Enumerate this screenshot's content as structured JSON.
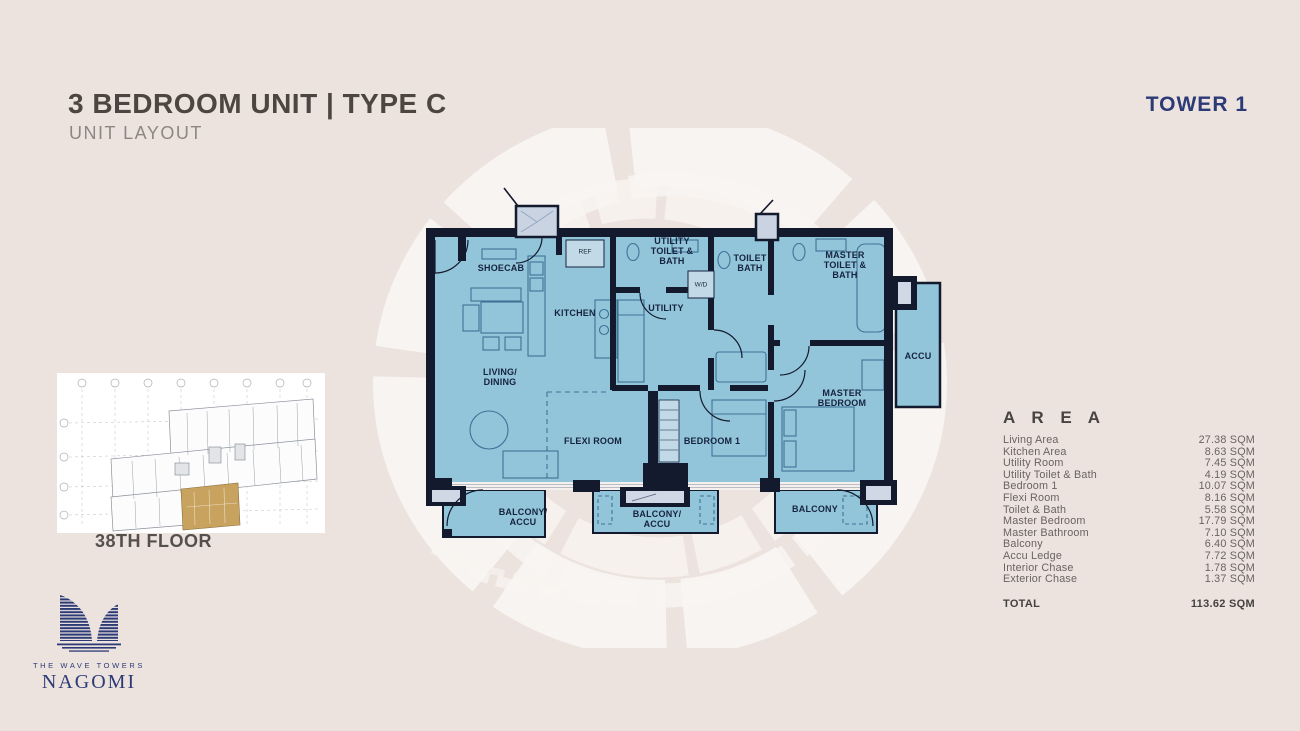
{
  "header": {
    "title": "3 BEDROOM UNIT | TYPE C",
    "subtitle": "UNIT LAYOUT",
    "tower": "TOWER 1"
  },
  "key_plan": {
    "floor_label": "38TH FLOOR"
  },
  "logo": {
    "tagline": "THE WAVE TOWERS",
    "brand": "NAGOMI"
  },
  "floor_plan": {
    "labels": {
      "shoecab": "SHOECAB",
      "ref": "REF",
      "kitchen": "KITCHEN",
      "utility_toilet_bath": "UTILITY\nTOILET &\nBATH",
      "wd": "W/D",
      "utility": "UTILITY",
      "toilet_bath": "TOILET\nBATH",
      "master_toilet_bath": "MASTER\nTOILET &\nBATH",
      "accu": "ACCU",
      "living_dining": "LIVING/\nDINING",
      "flexi_room": "FLEXI ROOM",
      "bedroom_1": "BEDROOM 1",
      "master_bedroom": "MASTER\nBEDROOM",
      "balcony_accu_left": "BALCONY/\nACCU",
      "balcony_accu_mid": "BALCONY/\nACCU",
      "balcony": "BALCONY"
    }
  },
  "area_table": {
    "header": "A R E A",
    "rows": [
      {
        "label": "Living Area",
        "value": "27.38 SQM"
      },
      {
        "label": "Kitchen Area",
        "value": "8.63 SQM"
      },
      {
        "label": "Utility Room",
        "value": "7.45 SQM"
      },
      {
        "label": "Utility Toilet & Bath",
        "value": "4.19 SQM"
      },
      {
        "label": "Bedroom 1",
        "value": "10.07 SQM"
      },
      {
        "label": "Flexi Room",
        "value": "8.16 SQM"
      },
      {
        "label": "Toilet & Bath",
        "value": "5.58 SQM"
      },
      {
        "label": "Master Bedroom",
        "value": "17.79 SQM"
      },
      {
        "label": "Master Bathroom",
        "value": "7.10 SQM"
      },
      {
        "label": "Balcony",
        "value": "6.40 SQM"
      },
      {
        "label": "Accu Ledge",
        "value": "7.72 SQM"
      },
      {
        "label": "Interior Chase",
        "value": "1.78 SQM"
      },
      {
        "label": "Exterior Chase",
        "value": "1.37 SQM"
      }
    ],
    "total_label": "TOTAL",
    "total_value": "113.62 SQM"
  },
  "colors": {
    "background": "#ece3df",
    "accent_navy": "#2c3a76",
    "room_fill": "#92c4da",
    "wall": "#131a2d",
    "highlight_tan": "#c8a35f",
    "title_text": "#4d4640",
    "muted_text": "#8e8781",
    "area_text": "#6b6360"
  }
}
